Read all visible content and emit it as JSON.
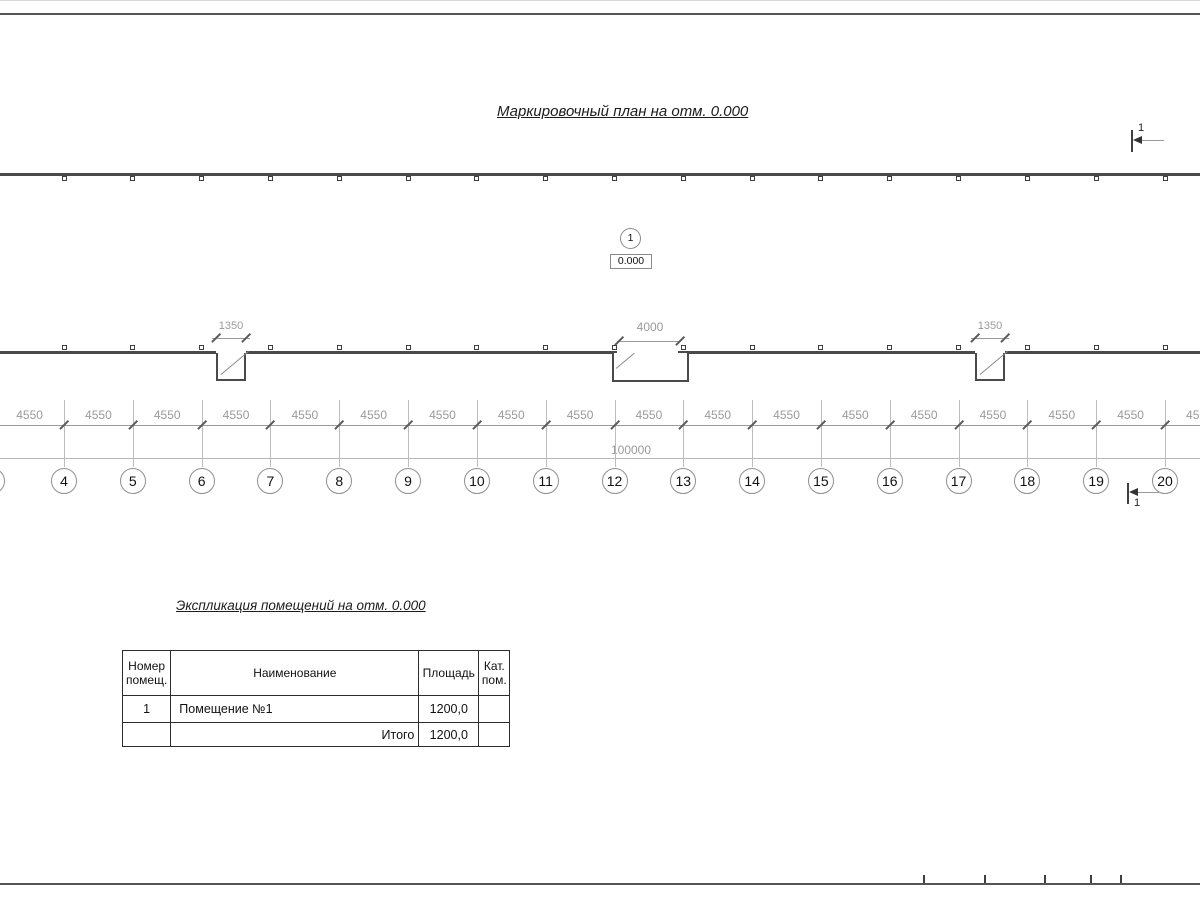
{
  "page": {
    "title": "Маркировочный план на отм. 0.000"
  },
  "plan": {
    "axes": [
      "4",
      "5",
      "6",
      "7",
      "8",
      "9",
      "10",
      "11",
      "12",
      "13",
      "14",
      "15",
      "16",
      "17",
      "18",
      "19",
      "20"
    ],
    "bay_dim_label": "4550",
    "total_dim_label": "100000",
    "openings": [
      {
        "label": "1350"
      },
      {
        "label": "4000"
      },
      {
        "label": "1350"
      }
    ],
    "room_marker": {
      "number": "1",
      "elevation": "0.000"
    },
    "section_mark_label": "1"
  },
  "table": {
    "title": "Экспликация помещений на отм. 0.000",
    "headers": [
      "Номер помещ.",
      "Наименование",
      "Площадь",
      "Кат. пом."
    ],
    "rows": [
      {
        "number": "1",
        "name": "Помещение №1",
        "area": "1200,0",
        "category": ""
      }
    ],
    "total_label": "Итого",
    "total_area": "1200,0"
  }
}
